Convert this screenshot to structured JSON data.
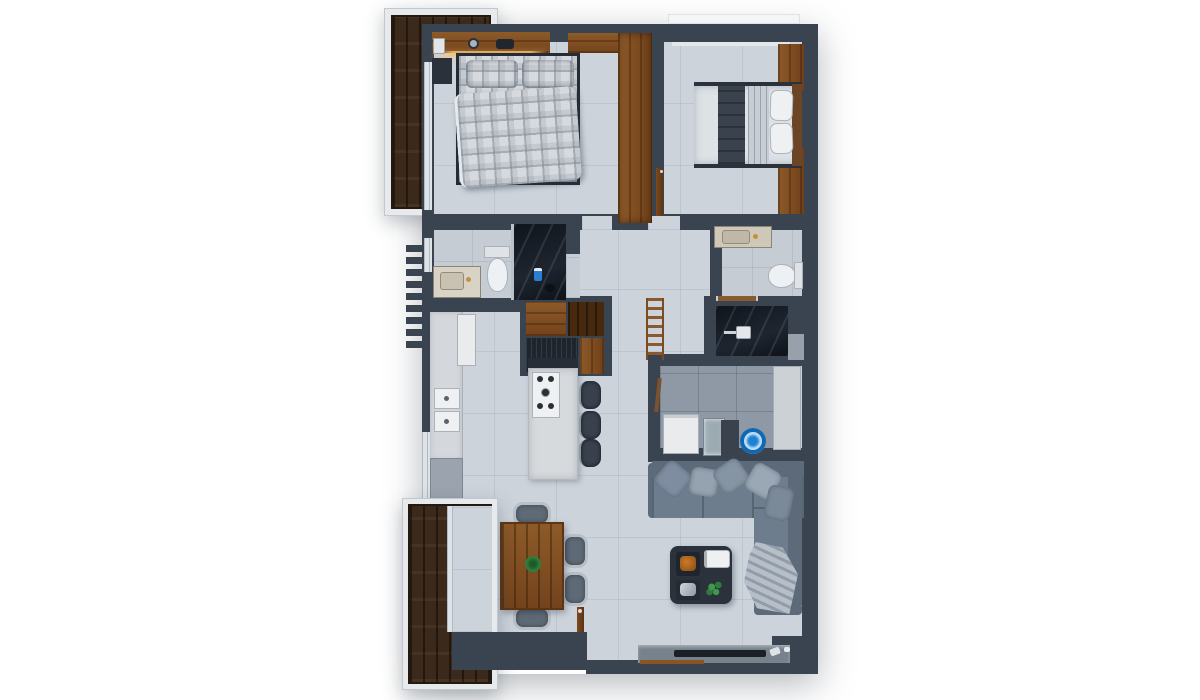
{
  "scene": {
    "kind": "apartment-floor-plan-3d-top-view",
    "render_style": "photoreal top-down render, no text labels",
    "background_color": "#ffffff"
  },
  "palette": {
    "outer_wall": "#3a4350",
    "floor_tile": "#ccd3db",
    "bath_floor": "#c5ccd4",
    "utility_floor": "#8f99a6",
    "balcony_wood": "#3b2a1b",
    "wardrobe_wood": "#83501f",
    "black_marble_shower": "#141a22",
    "sofa_gray": "#6e7d8d",
    "island_white": "#d8dbdf",
    "accent_blue_bucket": "#1b82d6",
    "plant_green": "#2f7d3d",
    "railing_white": "#e7eaec",
    "lamp_glow": "#f7c070"
  },
  "rooms": [
    {
      "id": "balcony-top-left",
      "name": "Balcony (top)",
      "features": [
        "dark wood deck",
        "white railing frame",
        "sliding glass door"
      ]
    },
    {
      "id": "master-bedroom",
      "name": "Master bedroom",
      "features": [
        "double bed with plaid duvet",
        "two plaid pillows",
        "wood headboard shelf with warm lamp glow",
        "clock",
        "phone",
        "two dark nightstands",
        "L-shaped wood wardrobe",
        "balcony glass door"
      ]
    },
    {
      "id": "bedroom-2",
      "name": "Bedroom 2",
      "features": [
        "double bed with gray runner",
        "two white pillows",
        "wood headboard",
        "two wood wardrobes",
        "entry door",
        "window at top"
      ]
    },
    {
      "id": "main-bathroom",
      "name": "Main bathroom",
      "features": [
        "marble vanity with sink",
        "toilet",
        "black marble shower",
        "window",
        "door opening"
      ]
    },
    {
      "id": "ensuite-bathroom",
      "name": "Ensuite bathroom",
      "features": [
        "marble vanity with sink",
        "toilet",
        "towel rail",
        "black marble shower with shower head"
      ]
    },
    {
      "id": "hallway",
      "name": "Hallway",
      "features": [
        "decorative wood towel ladder"
      ]
    },
    {
      "id": "kitchen",
      "name": "Kitchen",
      "features": [
        "wall counter run",
        "tall white fridge unit",
        "double wall oven",
        "island with gas cooktop",
        "three bar stools",
        "wood upper cabinets",
        "dark cabinet block",
        "window"
      ]
    },
    {
      "id": "utility-laundry",
      "name": "Utility / laundry",
      "features": [
        "white washer",
        "glass panel appliance",
        "dark panel",
        "blue round basin",
        "light door panel"
      ]
    },
    {
      "id": "living-room",
      "name": "Living room",
      "features": [
        "L-shaped gray sectional sofa",
        "five scatter pillows",
        "throw blanket",
        "dark coffee table with trays and plant",
        "TV ledge with TV",
        "entry door"
      ]
    },
    {
      "id": "dining-area",
      "name": "Dining area",
      "features": [
        "rectangular wood table",
        "six gray chairs",
        "green plant centerpiece"
      ]
    },
    {
      "id": "balcony-bottom-left",
      "name": "Balcony (bottom)",
      "features": [
        "dark wood deck",
        "white railing frame",
        "sliding glass door"
      ]
    },
    {
      "id": "exterior",
      "name": "Exterior detail",
      "features": [
        "sawtooth wall fins on left facade"
      ]
    }
  ]
}
